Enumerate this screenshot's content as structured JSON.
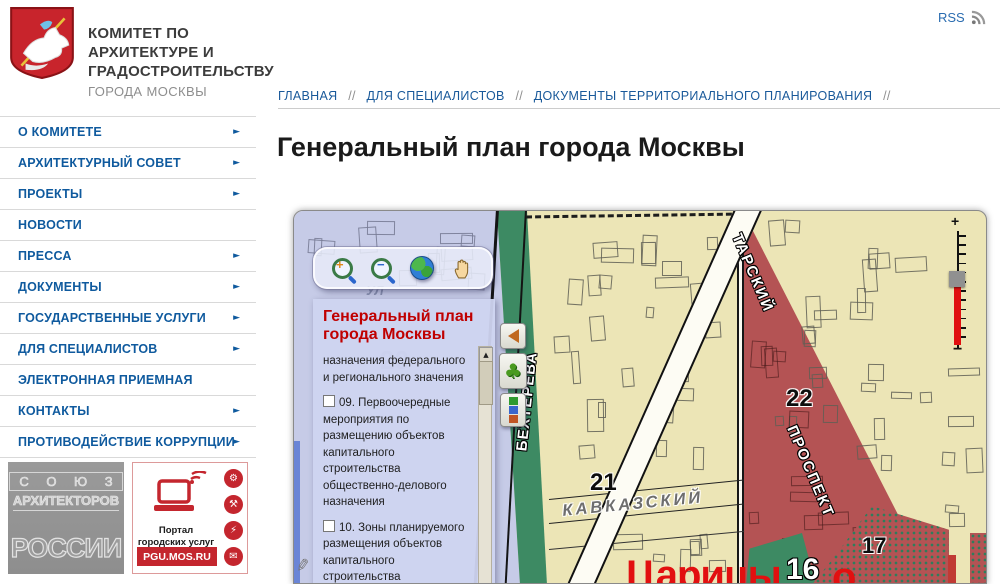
{
  "header": {
    "org_name_lines": [
      "КОМИТЕТ ПО",
      "АРХИТЕКТУРЕ И",
      "ГРАДОСТРОИТЕЛЬСТВУ"
    ],
    "org_sub": "ГОРОДА МОСКВЫ",
    "rss_label": "RSS"
  },
  "sidebar": {
    "items": [
      {
        "label": "О КОМИТЕТЕ",
        "has_submenu": true
      },
      {
        "label": "АРХИТЕКТУРНЫЙ СОВЕТ",
        "has_submenu": true
      },
      {
        "label": "ПРОЕКТЫ",
        "has_submenu": true
      },
      {
        "label": "НОВОСТИ",
        "has_submenu": false
      },
      {
        "label": "ПРЕССА",
        "has_submenu": true
      },
      {
        "label": "ДОКУМЕНТЫ",
        "has_submenu": true
      },
      {
        "label": "ГОСУДАРСТВЕННЫЕ УСЛУГИ",
        "has_submenu": true
      },
      {
        "label": "ДЛЯ СПЕЦИАЛИСТОВ",
        "has_submenu": true
      },
      {
        "label": "ЭЛЕКТРОННАЯ ПРИЕМНАЯ",
        "has_submenu": false
      },
      {
        "label": "КОНТАКТЫ",
        "has_submenu": true
      },
      {
        "label": "ПРОТИВОДЕЙСТВИЕ КОРРУПЦИИ",
        "has_submenu": true
      }
    ]
  },
  "banners": {
    "union": {
      "line1": "С О Ю З",
      "line2": "АРХИТЕКТОРОВ",
      "line3": "РОССИИ"
    },
    "portal": {
      "caption_line1": "Портал",
      "caption_line2": "городских услуг",
      "url": "PGU.MOS.RU",
      "service_icon_glyphs": [
        "⚙",
        "⚒",
        "⚡",
        "✉"
      ]
    }
  },
  "breadcrumb": {
    "separator": "//",
    "items": [
      "ГЛАВНАЯ",
      "ДЛЯ СПЕЦИАЛИСТОВ",
      "ДОКУМЕНТЫ ТЕРРИТОРИАЛЬНОГО ПЛАНИРОВАНИЯ"
    ]
  },
  "page": {
    "title": "Генеральный план города Москвы"
  },
  "map": {
    "legend": {
      "title_line1": "Генеральный план",
      "title_line2": "города Москвы",
      "items": [
        {
          "has_checkbox": false,
          "checked": false,
          "text": "назначения федерального и регионального значения"
        },
        {
          "has_checkbox": true,
          "checked": false,
          "text": "09. Первоочередные мероприятия по размещению объектов капитального строительства общественно-делового назначения"
        },
        {
          "has_checkbox": true,
          "checked": false,
          "text": "10. Зоны планируемого размещения объектов капитального строительства производственного"
        }
      ]
    },
    "labels": {
      "street_bekhtereva": "БЕХТЕРЕВА",
      "street_tarsky": "ТАРСКИЙ",
      "street_prospekt": "ПРОСПЕКТ",
      "street_kavkazsky": "КАВКАЗСКИЙ",
      "street_ul": "УЛ",
      "district_20": "20",
      "district_21": "21",
      "district_22": "22",
      "district_17": "17",
      "district_16": "16",
      "place_name_part1": "Царицы",
      "place_name_part2": "о"
    },
    "slider": {
      "zoom_in": "+",
      "zoom_out": "−"
    },
    "colors": {
      "zone_beige": "#ece5b6",
      "zone_lavender": "#c6cbe7",
      "zone_green": "#3d8a63",
      "zone_red": "#b45354",
      "legend_panel": "#ced3ee",
      "legend_title": "#cc0000",
      "accent_blue": "#0f5a9e",
      "brand_red": "#c4262e"
    }
  }
}
